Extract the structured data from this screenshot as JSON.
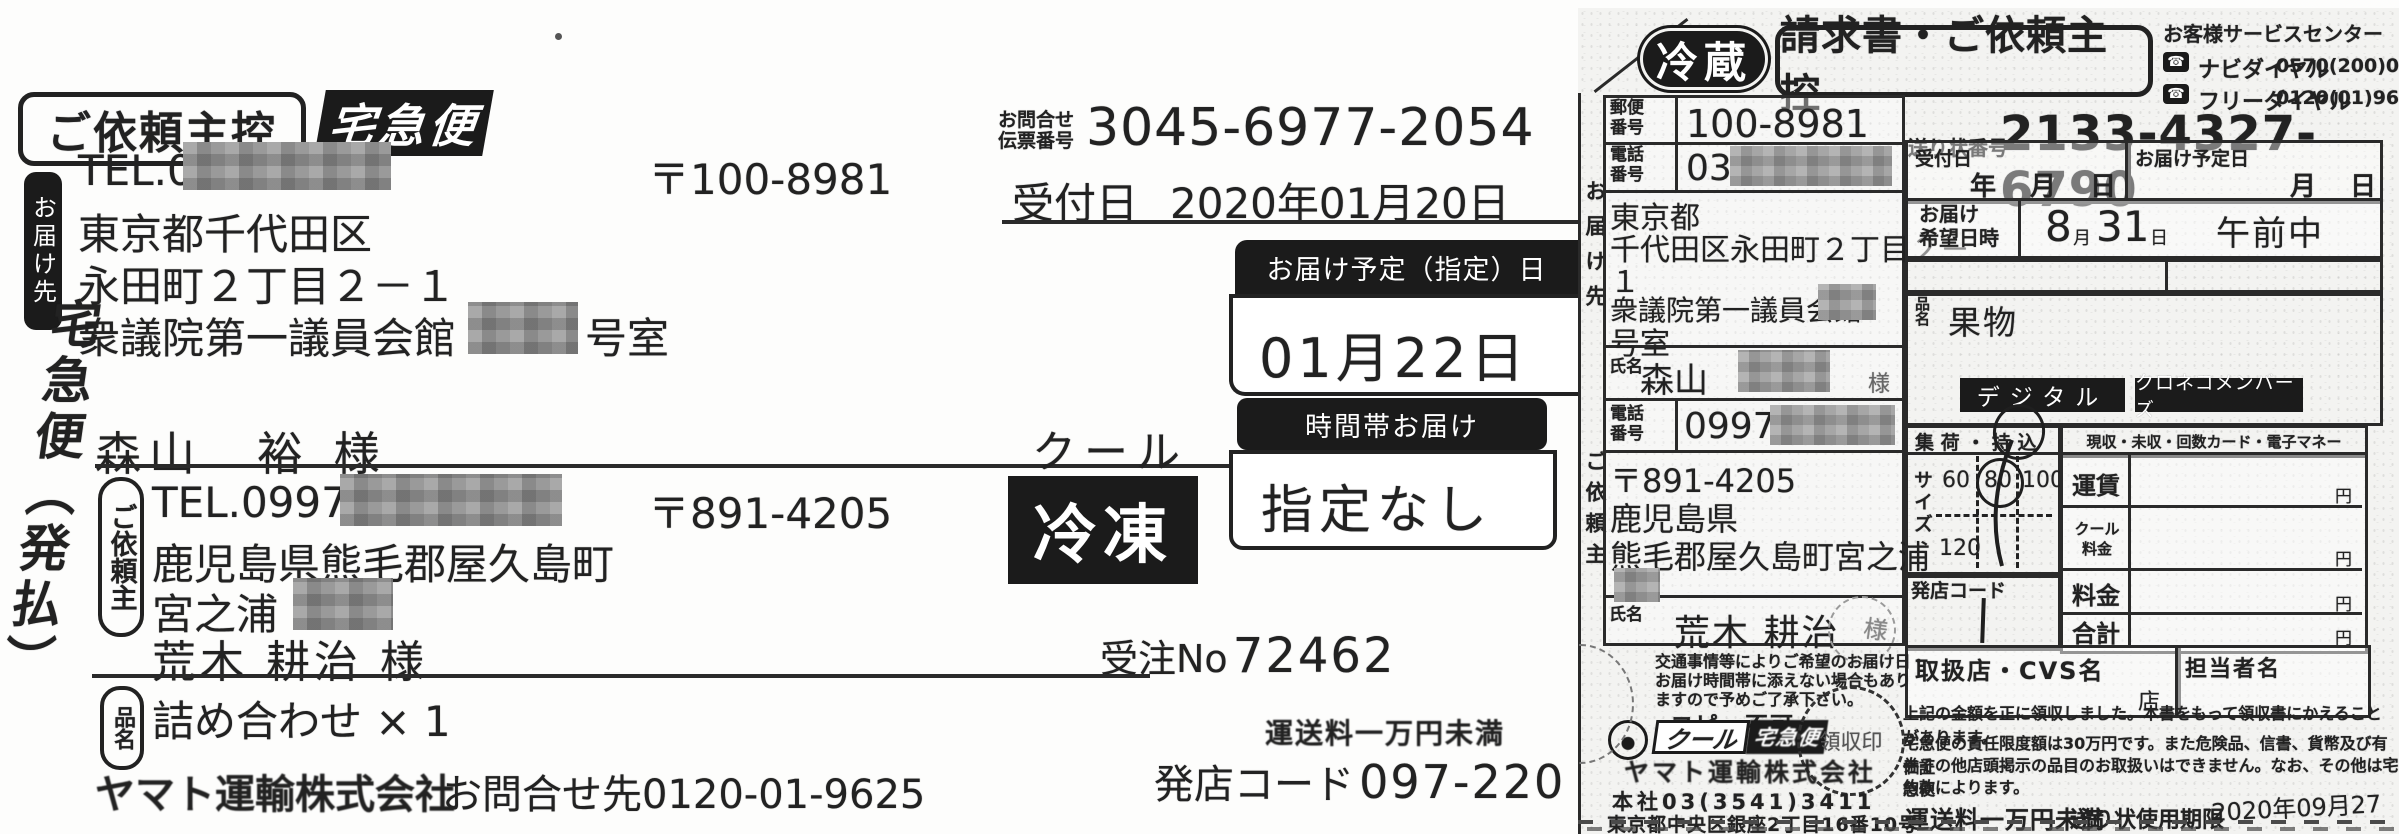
{
  "left": {
    "copy_label": "ご依頼主控",
    "service_badge": "宅急便",
    "dest_side_label": "お届け先",
    "dest": {
      "tel": "TEL.03",
      "postal": "〒100-8981",
      "addr1": "東京都千代田区",
      "addr2": "永田町２丁目２－１",
      "addr3": "衆議院第一議員会館",
      "addr3_suffix": "号室",
      "name": "森山　裕 様"
    },
    "vertical_service": "宅急便（発払）",
    "inquiry_label_1": "お問合せ",
    "inquiry_label_2": "伝票番号",
    "inquiry_no": "3045-6977-2054",
    "accept_label": "受付日",
    "accept_date": "2020年01月20日",
    "delivery_badge": "お届け予定（指定）日",
    "delivery_date": "01月22日",
    "time_badge": "時間帯お届け",
    "time_value": "指定なし",
    "cool_label": "クール",
    "cool_value": "冷凍",
    "sender_side_label": "ご依頼主",
    "sender": {
      "tel": "TEL.0997-",
      "postal": "〒891-4205",
      "addr1": "鹿児島県熊毛郡屋久島町",
      "addr2": "宮之浦",
      "name": "荒木 耕治 様"
    },
    "order_label": "受注No",
    "order_no": "72462",
    "item_side_label": "品名",
    "item_value": "詰め合わせ × 1",
    "company": "ヤマト運輸株式会社",
    "company_contact": "お問合せ先0120-01-9625",
    "fare_note": "運送料一万円未満",
    "store_code_label": "発店コード",
    "store_code": "097-220"
  },
  "right": {
    "chill_badge": "冷蔵",
    "copy_label": "請求書・ご依頼主控",
    "service_center": {
      "title": "お客様サービスセンター",
      "navi_label": "ナビダイヤル",
      "navi_number": "0570(200)000",
      "free_label": "フリーダイヤル",
      "free_number": "0120(01)9625"
    },
    "tracking_label": "送り状番号",
    "tracking_no": "2133-4327-6790",
    "dest_side_label": "お届け先",
    "sender_side_label": "ご依頼主",
    "dest": {
      "postal_label": "郵便番号",
      "postal": "100-8981",
      "tel_label": "電話番号",
      "tel": "03",
      "addr_lines": [
        "東京都",
        "千代田区永田町２丁目２－",
        "１",
        "衆議院第一議員会館",
        "号室"
      ],
      "name_label": "氏名",
      "name": "森山",
      "honorific": "様"
    },
    "sender": {
      "tel_label": "電話番号",
      "tel": "0997",
      "postal": "〒891-4205",
      "addr1": "鹿児島県",
      "addr2": "熊毛郡屋久島町宮之浦",
      "name_label": "氏名",
      "name": "荒木 耕治",
      "honorific": "様"
    },
    "accept": {
      "label": "受付日",
      "year": "年",
      "month": "月",
      "day": "日"
    },
    "scheduled": {
      "label": "お届け予定日",
      "month": "月",
      "day": "日"
    },
    "request": {
      "label_1": "お届け",
      "label_2": "希望日時",
      "month_num": "8",
      "month_unit": "月",
      "day_num": "31",
      "day_unit": "日",
      "slot": "午前中"
    },
    "item": {
      "label": "品名",
      "value": "果物"
    },
    "badge_digital": "デジタル",
    "badge_members": "クロネコメンバーズ",
    "pickup_header": "集 荷 ・ 持 込",
    "payment_header": "現収・未収・回数カード・電子マネー",
    "size_label": "サイズ",
    "sizes": [
      "60",
      "80",
      "100",
      "120"
    ],
    "store_code_label": "発店コード",
    "fees": [
      {
        "label": "運賃",
        "unit": "円"
      },
      {
        "label": "クール料金",
        "unit": "円"
      },
      {
        "label": "料金",
        "unit": "円"
      },
      {
        "label": "合計",
        "unit": "円"
      }
    ],
    "handling_store_label": "取扱店・CVS名",
    "store_suffix": "店",
    "staff_label": "担当者名",
    "notice_lines": [
      "交通事情等によりご希望のお届け日・",
      "お届け時間帯に添えない場合もあり",
      "ますので予めご了承下さい。"
    ],
    "no_copy": "コピー不可",
    "cool_badge_left": "クール",
    "cool_badge_right": "宅急便",
    "receipt_stamp": "領収印",
    "company": "ヤマト運輸株式会社",
    "hq_tel": "本社03(3541)3411",
    "hq_addr": "東京都中央区銀座2丁目16番10号",
    "receipt_note": "上記の金額を正に領収しました。本書をもって領収書にかえることがあります。",
    "liability_lines": [
      "宅急便の責任限度額は30万円です。また危険品、信書、貨幣及び有価証",
      "券その他店頭掲示の品目のお取扱いはできません。なお、その他は宅急便",
      "約款によります。"
    ],
    "fare_note": "運送料一万円未満",
    "expiry_label": "送り状使用期限",
    "expiry_date": "2020年09月27日"
  }
}
